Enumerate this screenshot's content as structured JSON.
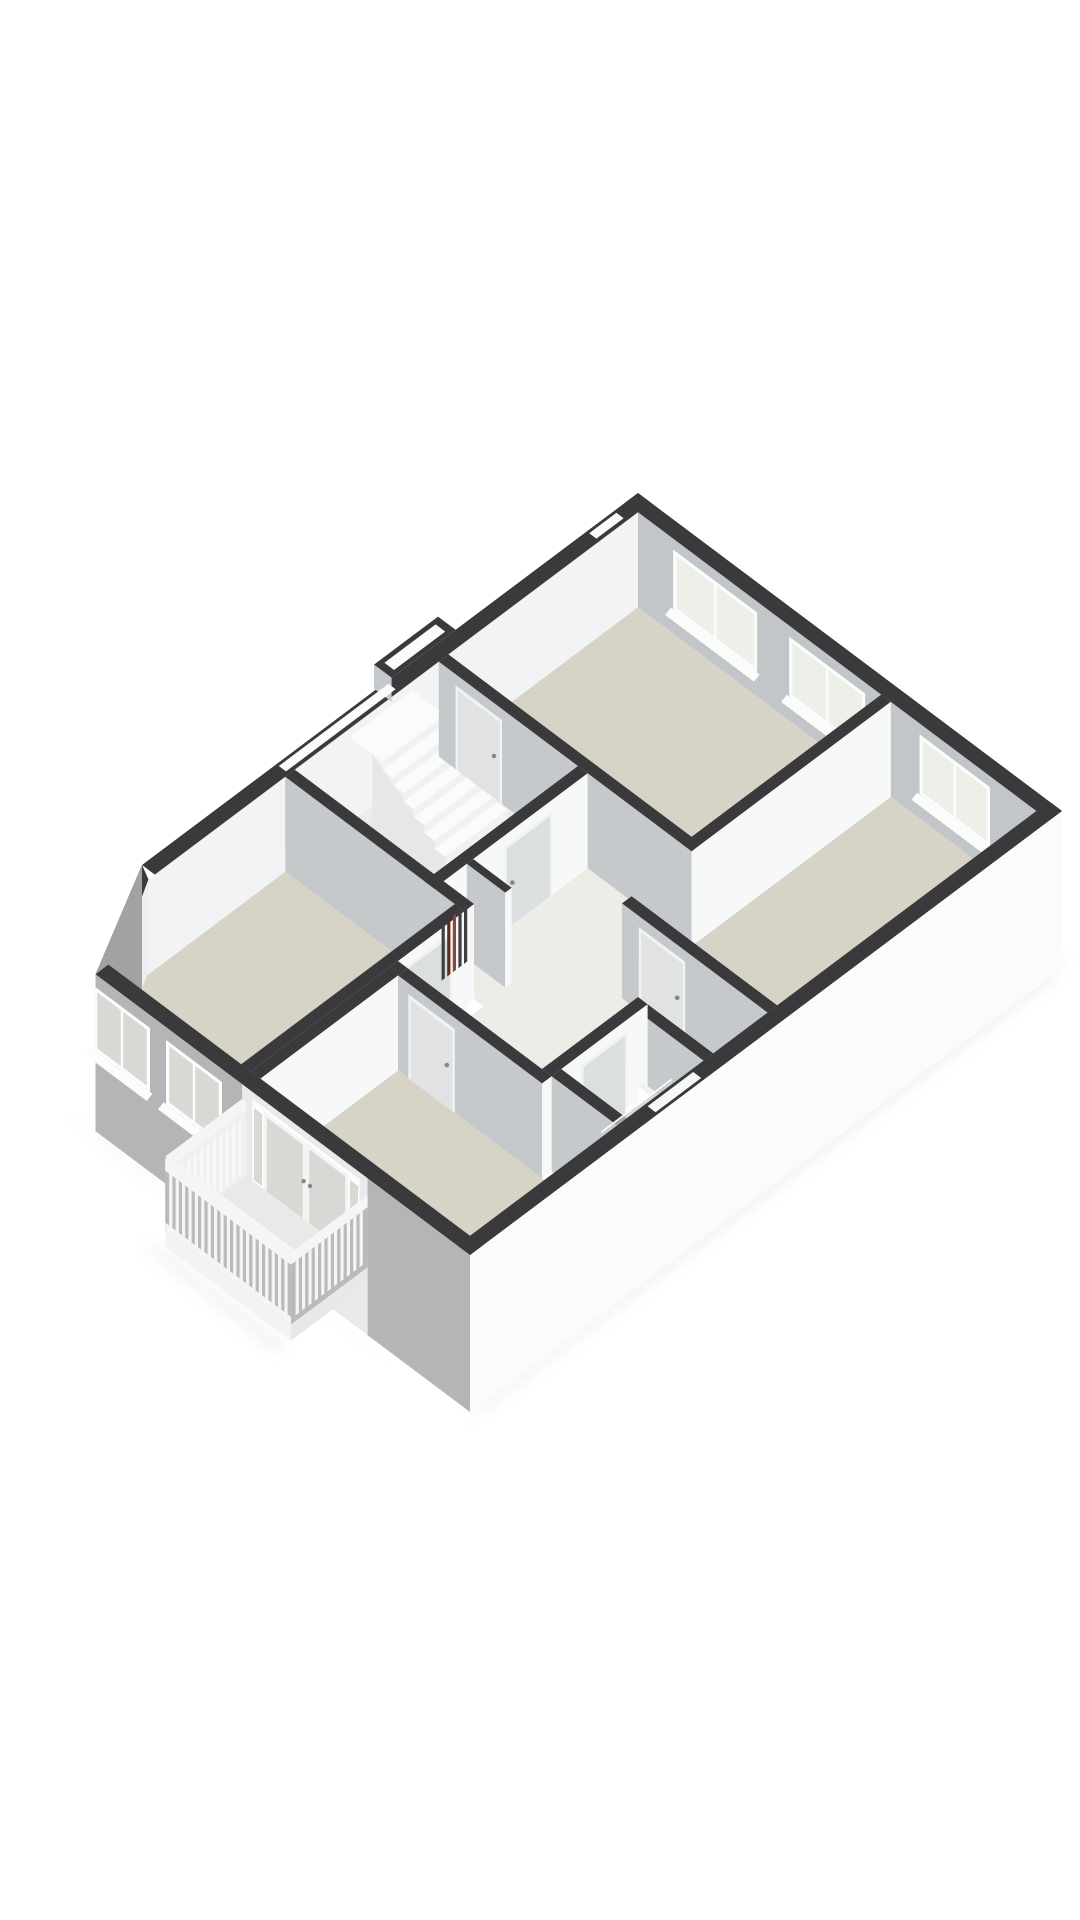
{
  "scene": {
    "type": "3d-floorplan-render",
    "description": "Isometric 3D floor plan of an upper storey, white background, no text",
    "canvas": {
      "width": 1080,
      "height": 1920,
      "background": "#ffffff"
    }
  },
  "projection": {
    "origin_x": 638,
    "origin_y": 588,
    "u": [
      0.8,
      0.6
    ],
    "v": [
      -0.8,
      0.6
    ],
    "wall_height": 95,
    "ground_depth": 62
  },
  "palette": {
    "wall_cap": "#3a3a3c",
    "face_se": "#f7f8f8",
    "face_sw": "#c6c9cb",
    "wall_interior_ne": "#c3c6c8",
    "wall_interior_nw": "#f2f3f4",
    "chamfer_in": "#eceeef",
    "ext_se": "#fbfbfc",
    "ext_sw": "#b3b5b7",
    "ext_porch": "#e9eaeb",
    "ext_chamfer": "#a0a2a4",
    "floor_room": "#d7d3c7",
    "floor_hall": "#edece6",
    "floor_bath": "#dad6ca",
    "floor_balcony": "#e9e9e7",
    "window_frame": "#fbfcfc",
    "glass_in": "#edefe9",
    "glass_out": "#d7d9d5",
    "railing": "#f4f5f6",
    "railing_back": "#b8babc",
    "railing_panel": "#eef0f1",
    "stair_top": "#fafbfb",
    "stair_riser": "#eff1f2",
    "stair_stringer": "#e5e7e8",
    "door_leaf": "#e0e2e3",
    "door_frame": "#f1f3f3",
    "handle": "#85878a",
    "pipe_dark": "#3f3f41",
    "pipe_red": "#8a4a3a",
    "pipe_red2": "#5f2b22",
    "fixture": "#fdfdfe",
    "fixture_shade": "#eef0f0",
    "glass_screen": "#ccd0ca",
    "metal": "#9fa1a3",
    "shadow": "#dfe0e0"
  },
  "footprint": {
    "a_len": 530,
    "b_len": 740,
    "t": 16,
    "chamfer": {
      "outer_from": [
        0,
        620
      ],
      "outer_to": [
        62,
        740
      ],
      "inner_from": [
        16,
        628
      ],
      "inner_to": [
        70,
        724
      ]
    },
    "bay": {
      "b0": 228,
      "b1": 308,
      "depth": 22
    },
    "slots_nw": [
      [
        315,
        452
      ],
      [
        30,
        64
      ]
    ],
    "slot_se": [
      448,
      505
    ]
  },
  "floors": [
    {
      "name": "bedroom-top-floor",
      "color": "floor_room",
      "poly": [
        [
          16,
          16
        ],
        [
          320,
          16
        ],
        [
          320,
          253
        ],
        [
          16,
          253
        ]
      ]
    },
    {
      "name": "bedroom-right-floor",
      "color": "floor_room",
      "poly": [
        [
          332,
          16
        ],
        [
          514,
          16
        ],
        [
          514,
          340
        ],
        [
          332,
          340
        ]
      ]
    },
    {
      "name": "hallway-landing-floor",
      "color": "floor_hall",
      "poly": [
        [
          16,
          265
        ],
        [
          332,
          265
        ],
        [
          332,
          352
        ],
        [
          514,
          352
        ],
        [
          514,
          540
        ],
        [
          252,
          540
        ],
        [
          252,
          445
        ],
        [
          16,
          445
        ]
      ]
    },
    {
      "name": "bathroom-floor",
      "color": "floor_bath",
      "poly": [
        [
          432,
          432
        ],
        [
          514,
          432
        ],
        [
          514,
          528
        ],
        [
          432,
          528
        ]
      ]
    },
    {
      "name": "bedroom-left-floor",
      "color": "floor_room",
      "poly": [
        [
          16,
          457
        ],
        [
          228,
          457
        ],
        [
          228,
          724
        ],
        [
          72,
          724
        ],
        [
          16,
          630
        ]
      ]
    },
    {
      "name": "room-bottom-floor",
      "color": "floor_room",
      "poly": [
        [
          252,
          552
        ],
        [
          514,
          552
        ],
        [
          514,
          724
        ],
        [
          252,
          724
        ]
      ]
    }
  ],
  "walls": [
    {
      "name": "wall-bedroom-top-right",
      "a": [
        320,
        332
      ],
      "b": [
        16,
        265
      ]
    },
    {
      "name": "wall-bedroom-top-south",
      "a": [
        16,
        332
      ],
      "b": [
        253,
        265
      ],
      "doors": [
        {
          "face": "b",
          "from": 40,
          "to": 92
        }
      ]
    },
    {
      "name": "wall-bedroom-right-south",
      "a": [
        332,
        514
      ],
      "b": [
        340,
        352
      ],
      "doors": [
        {
          "face": "b",
          "from": 356,
          "to": 408
        }
      ]
    },
    {
      "name": "wall-stairhall",
      "a": [
        190,
        202
      ],
      "b": [
        265,
        470
      ],
      "doors": [
        {
          "face": "a",
          "from": 312,
          "to": 366
        }
      ]
    },
    {
      "name": "wall-closet-top",
      "a": [
        202,
        250
      ],
      "b": [
        408,
        416
      ]
    },
    {
      "name": "wall-closet-bottom",
      "a": [
        202,
        250
      ],
      "b": [
        462,
        470
      ]
    },
    {
      "name": "wall-corridor-left",
      "a": [
        16,
        240
      ],
      "b": [
        445,
        457
      ]
    },
    {
      "name": "wall-bathroom-north",
      "a": [
        432,
        514
      ],
      "b": [
        420,
        432
      ]
    },
    {
      "name": "wall-bedroom-left-east",
      "a": [
        228,
        240
      ],
      "b": [
        457,
        724
      ],
      "doors": [
        {
          "face": "a",
          "from": 475,
          "to": 527
        }
      ]
    },
    {
      "name": "wall-bathroom-west",
      "a": [
        420,
        432
      ],
      "b": [
        420,
        540
      ],
      "doors": [
        {
          "face": "a",
          "from": 448,
          "to": 500
        }
      ]
    },
    {
      "name": "wall-room-bottom-west",
      "a": [
        240,
        252
      ],
      "b": [
        540,
        724
      ]
    },
    {
      "name": "wall-bathroom-south",
      "a": [
        432,
        514
      ],
      "b": [
        528,
        540
      ]
    },
    {
      "name": "wall-room-bottom-north",
      "a": [
        252,
        432
      ],
      "b": [
        540,
        552
      ],
      "doors": [
        {
          "face": "b",
          "from": 268,
          "to": 320
        }
      ]
    }
  ],
  "windows_ne": [
    {
      "name": "window-bedroom-top-1",
      "a": [
        60,
        165
      ],
      "sill": 24,
      "top": 84
    },
    {
      "name": "window-bedroom-top-2",
      "a": [
        205,
        300
      ],
      "sill": 24,
      "top": 84
    },
    {
      "name": "window-bedroom-right",
      "a": [
        368,
        456
      ],
      "sill": 24,
      "top": 84
    }
  ],
  "windows_sw": [
    {
      "name": "window-bedroom-left-1",
      "a": [
        60,
        130
      ],
      "sill": 18,
      "top": 82
    },
    {
      "name": "window-bedroom-left-2",
      "a": [
        150,
        220
      ],
      "sill": 18,
      "top": 82
    }
  ],
  "french_doors": {
    "name": "french-doors-room-bottom",
    "a": [
      258,
      392
    ],
    "h_top": 88,
    "leaves": [
      [
        272,
        325
      ],
      [
        325,
        378
      ]
    ],
    "sidelights": [
      [
        260,
        270
      ],
      [
        380,
        390
      ]
    ],
    "handles": [
      322,
      330
    ]
  },
  "stairs": {
    "name": "staircase",
    "a0": 44,
    "treads": 10,
    "tread_depth": 13,
    "b": [
      298,
      376
    ],
    "h_top": 86,
    "rise": 8,
    "landing_a": [
      16,
      44
    ]
  },
  "balcony": {
    "name": "balcony-with-balustrade",
    "a": [
      245,
      402
    ],
    "b": [
      740,
      836
    ],
    "rail_h": 78,
    "slat_step": 8,
    "slat_w": 4
  },
  "fixtures": {
    "pipes": {
      "name": "meter-closet-pipes",
      "plane_a": 204.5,
      "b0": 418,
      "step": 7,
      "w": 4,
      "h": 56,
      "colors": [
        "pipe_dark",
        "pipe_dark",
        "pipe_red",
        "pipe_red2",
        "pipe_dark"
      ]
    },
    "toilet": {
      "name": "toilet",
      "cx": 452,
      "cy": 452
    },
    "screen": {
      "name": "glass-screen",
      "plane_a": 478,
      "b": [
        436,
        524
      ],
      "h": 58
    },
    "sink": {
      "name": "washbasin",
      "a": [
        492,
        514
      ],
      "b": [
        492,
        522
      ],
      "h": 30
    }
  }
}
